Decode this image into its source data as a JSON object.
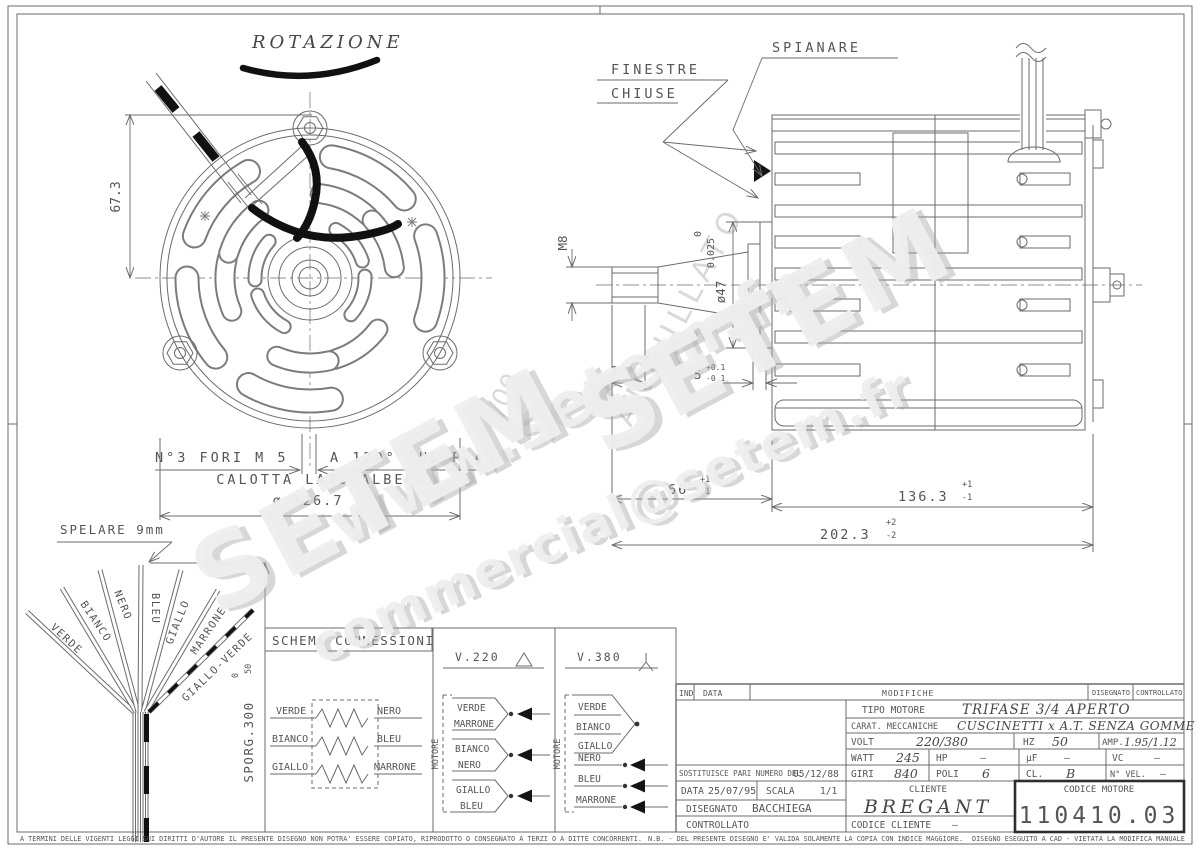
{
  "labels": {
    "rotazione": "ROTAZIONE",
    "finestre1": "FINESTRE",
    "finestre2": "CHIUSE",
    "spianare": "SPIANARE",
    "spelare": "SPELARE 9mm"
  },
  "front": {
    "h673": "67.3",
    "fori": "N°3 FORI M 5",
    "angle": "A 120° SUL R 48",
    "calotta": "CALOTTA LATO ALBERO",
    "dia": "ø 126.7"
  },
  "side": {
    "m8": "M8",
    "run0": "0",
    "run025": "0.025",
    "dia47": "ø47",
    "d13": "13",
    "d5": "5",
    "d5p": "+0.1",
    "d5m": "-0.1",
    "d66": "66",
    "d66p": "+1",
    "d66m": "-1",
    "d136": "136.3",
    "d136p": "+1",
    "d136m": "-1",
    "d202": "202.3",
    "d202p": "+2",
    "d202m": "-2"
  },
  "pencil": {
    "annullato": "ANNULLATO",
    "rev": "/00"
  },
  "wires": {
    "labels": [
      "VERDE",
      "BIANCO",
      "NERO",
      "BLEU",
      "GIALLO",
      "MARRONE",
      "GIALLO-VERDE"
    ],
    "sporg": "SPORG.300",
    "sporgp": "50",
    "sporgm": "0"
  },
  "schema": {
    "title": "SCHEMA CONNESSIONI",
    "motore": "MOTORE",
    "windings_left": [
      "VERDE",
      "BIANCO",
      "GIALLO"
    ],
    "windings_right": [
      "NERO",
      "BLEU",
      "MARRONE"
    ],
    "v220": {
      "title": "V.220",
      "pairs": [
        [
          "VERDE",
          "MARRONE"
        ],
        [
          "BIANCO",
          "NERO"
        ],
        [
          "GIALLO",
          "BLEU"
        ]
      ]
    },
    "v380": {
      "title": "V.380",
      "star": [
        "VERDE",
        "BIANCO",
        "GIALLO"
      ],
      "phases": [
        "NERO",
        "BLEU",
        "MARRONE"
      ]
    }
  },
  "tb": {
    "ind": "IND",
    "data_col": "DATA",
    "modifiche": "MODIFICHE",
    "disegnato_col": "DISEGNATO",
    "controllato_col": "CONTROLLATO",
    "tipo_label": "TIPO MOTORE",
    "tipo": "TRIFASE 3/4 APERTO",
    "carat_label": "CARAT. MECCANICHE",
    "carat": "CUSCINETTI x A.T. SENZA GOMME",
    "volt_label": "VOLT",
    "volt": "220/380",
    "hz_label": "HZ",
    "hz": "50",
    "amp_label": "AMP.",
    "amp": "1.95/1.12",
    "watt_label": "WATT",
    "watt": "245",
    "hp_label": "HP",
    "hp": "–",
    "uf_label": "µF",
    "uf": "–",
    "vc_label": "VC",
    "vc": "–",
    "giri_label": "GIRI",
    "giri": "840",
    "poli_label": "POLI",
    "poli": "6",
    "cl_label": "CL.",
    "cl": "B",
    "nvel_label": "N° VEL.",
    "nvel": "–",
    "sostituisce": "SOSTITUISCE PARI NUMERO DEL",
    "sostituisce_date": "05/12/88",
    "data_label": "DATA",
    "data": "25/07/95",
    "scala_label": "SCALA",
    "scala": "1/1",
    "disegnato_label": "DISEGNATO",
    "disegnato": "BACCHIEGA",
    "controllato_label": "CONTROLLATO",
    "cliente_label": "CLIENTE",
    "cliente": "BREGANT",
    "codcli_label": "CODICE CLIENTE",
    "codcli": "–",
    "codmot_label": "CODICE MOTORE",
    "codmot": "110410.03"
  },
  "wm": {
    "w1": "www.setem.fr",
    "w2": "SETEM",
    "w3": "SETEM",
    "w4": "commercial@setem.fr"
  },
  "footer": {
    "f1": "A TERMINI DELLE VIGENTI LEGGI SUI DIRITTI D'AUTORE IL PRESENTE DISEGNO NON POTRA' ESSERE COPIATO, RIPRODOTTO O CONSEGNATO A TERZI O A DITTE CONCORRENTI.",
    "f2": "N.B. - DEL PRESENTE DISEGNO E' VALIDA SOLAMENTE LA COPIA CON INDICE MAGGIORE.",
    "f3": "DISEGNO ESEGUITO A CAD - VIETATA LA MODIFICA MANUALE"
  }
}
